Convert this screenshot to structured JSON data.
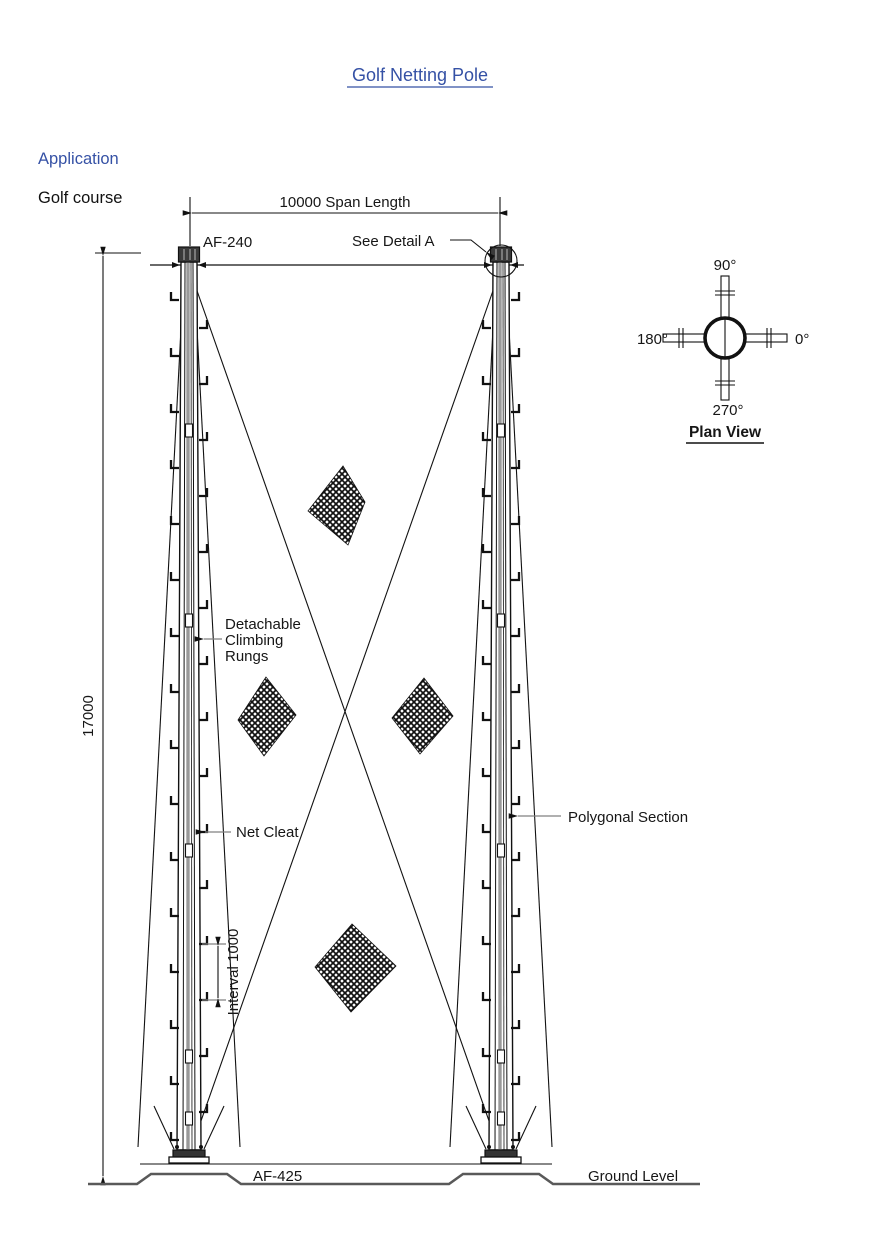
{
  "title": "Golf Netting Pole",
  "application": {
    "heading": "Application",
    "value": "Golf course"
  },
  "diagram": {
    "span_label": "10000 Span Length",
    "height_label": "17000",
    "top_fitting_label": "AF-240",
    "detail_label": "See Detail A",
    "rungs_label_lines": [
      "Detachable",
      "Climbing",
      "Rungs"
    ],
    "net_cleat_label": "Net Cleat",
    "interval_label": "Interval 1000",
    "polygonal_label": "Polygonal Section",
    "base_fitting_label": "AF-425",
    "ground_label": "Ground Level"
  },
  "plan_view": {
    "caption": "Plan View",
    "angle_top": "90°",
    "angle_right": "0°",
    "angle_left": "180°",
    "angle_bottom": "270°"
  },
  "colors": {
    "accent_blue": "#3551a5",
    "line": "#111111",
    "leader_gray": "#808080",
    "ground_gray": "#595959"
  }
}
